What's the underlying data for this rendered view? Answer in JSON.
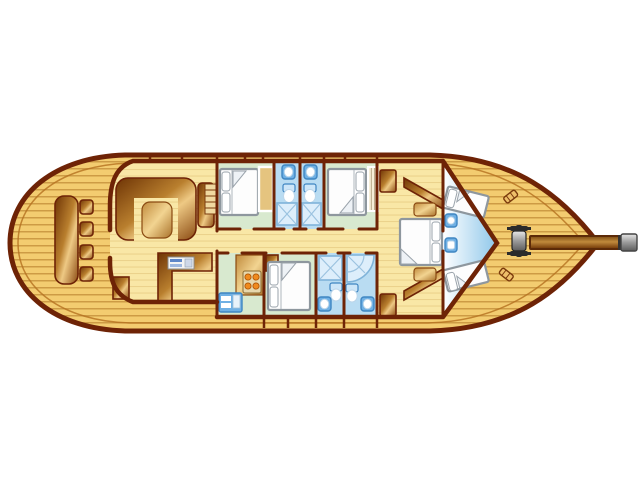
{
  "scene": {
    "type": "yacht-deck-plan",
    "view": "top-down interior layout of a gulet style motor-sailer, bow pointing right",
    "background": "#ffffff"
  },
  "colors": {
    "background": "#ffffff",
    "outline": "#6e2306",
    "caprail": "#b4701f",
    "deck": "#f3cc70",
    "deck_line": "#c08a36",
    "sole": "#f9e7a6",
    "sole_line": "#e0c077",
    "cabin_floor": "#d8e9cf",
    "bath_floor": "#b9dcf2",
    "shower_fill": "#ddeefb",
    "fixture_blue": "#6fb0e4",
    "fixture_outline": "#3f86c2",
    "wood_dark": "#6e3405",
    "wood_mid": "#b97f2e",
    "wood_light": "#eec984",
    "bed_fill": "#fdfdfd",
    "bed_outline": "#8e979e",
    "pillow": "#ffffff",
    "metal_light": "#e8e8e8",
    "metal_dark": "#5c5c5c",
    "burner_orange": "#f08a1e"
  },
  "legend": {
    "rooms": [
      {
        "id": "aft-deck"
      },
      {
        "id": "salon"
      },
      {
        "id": "corridor"
      },
      {
        "id": "guest-cabin-1"
      },
      {
        "id": "bathroom-1"
      },
      {
        "id": "bathroom-2"
      },
      {
        "id": "guest-cabin-2"
      },
      {
        "id": "galley"
      },
      {
        "id": "guest-cabin-3"
      },
      {
        "id": "bathroom-3"
      },
      {
        "id": "bathroom-4"
      },
      {
        "id": "master-cabin"
      },
      {
        "id": "bow-cabin"
      },
      {
        "id": "foredeck"
      }
    ],
    "equipment": [
      "dining-table",
      "deck-seat",
      "u-sofa",
      "salon-table",
      "nav-counter",
      "instrument-panel",
      "companionway-steps",
      "galley-counter",
      "stove",
      "galley-sink",
      "double-bed",
      "v-berth",
      "wardrobe",
      "shelf-unit",
      "washbasin",
      "toilet",
      "shower-tray",
      "corner-shower",
      "nightstand",
      "windlass",
      "mooring-cleat",
      "bowsprit"
    ],
    "counts": {
      "double_beds": 4,
      "v_berths": 2,
      "bathrooms": 4,
      "deck_seats": 4,
      "mooring_cleats": 2
    }
  }
}
